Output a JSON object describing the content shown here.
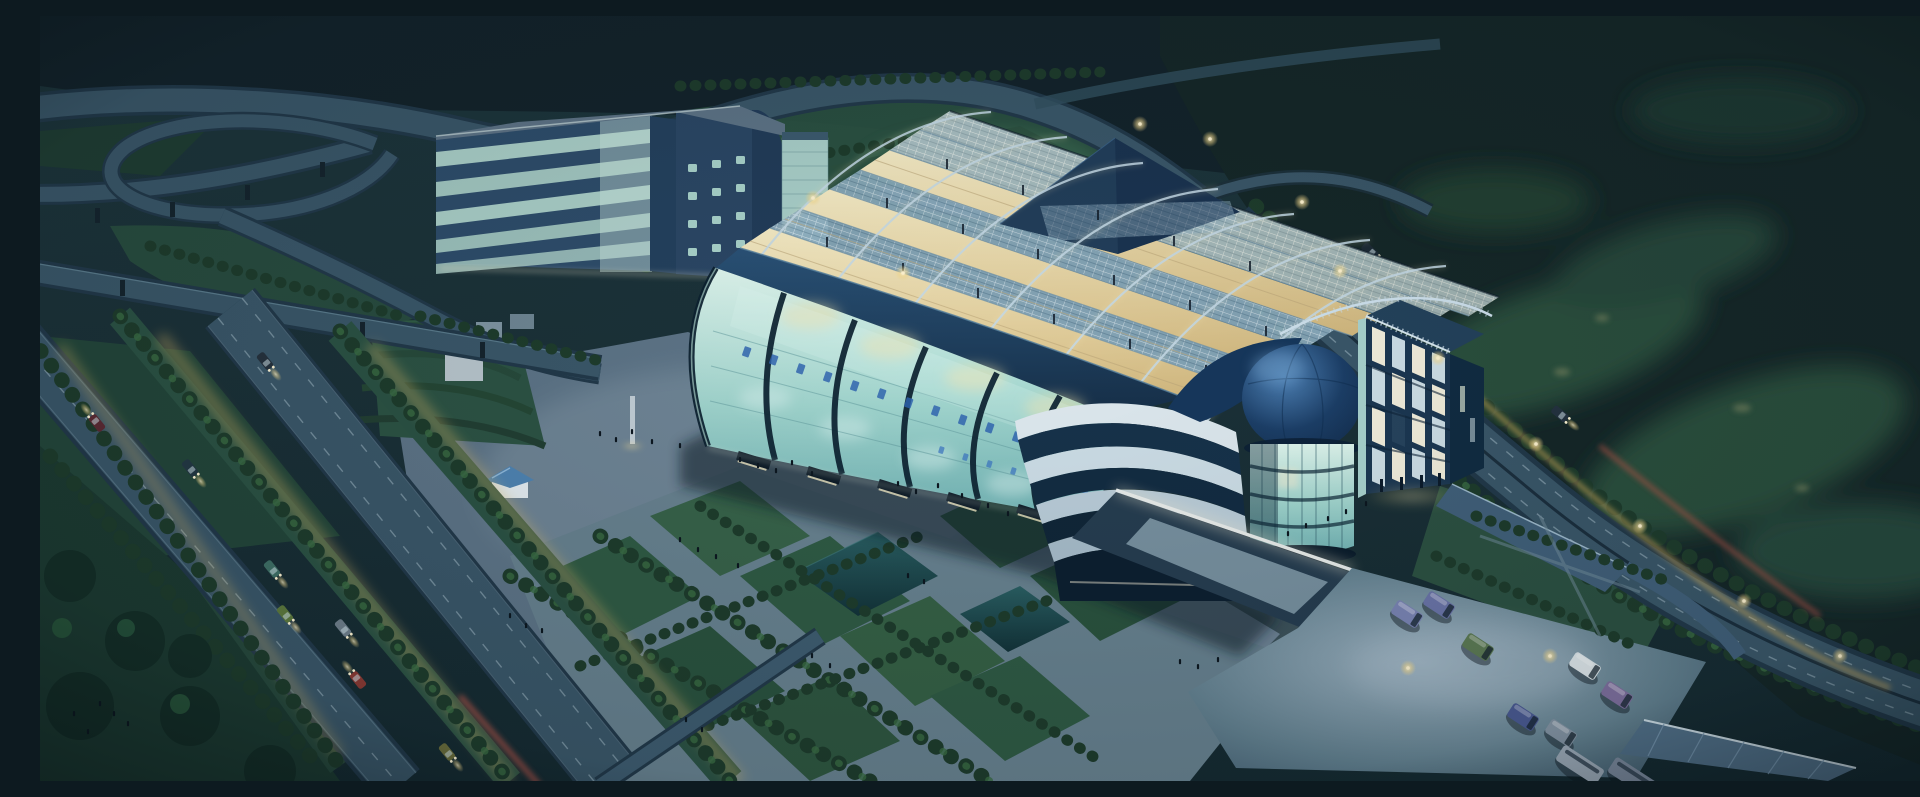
{
  "canvas": {
    "width": 1920,
    "height": 765
  },
  "scene": {
    "title": "Aerial night rendering of a glass exhibition center campus",
    "type": "architectural rendering",
    "time_of_day": "night",
    "view": "aerial oblique",
    "focal_building": "long glass exhibition hall with arched steel roof trusses lit warmly from inside",
    "secondary_buildings": [
      "striped office slab with rounded dark tower",
      "glass drum tower topped by a blue dome",
      "office block with grid of lit windows",
      "stepped curved white-banded wing"
    ],
    "landscape": [
      "dark forested hills",
      "golf-course clearings",
      "tree-lined boulevards",
      "landscaped plaza with lawns, paths and ponds"
    ],
    "infrastructure": [
      "highway interchange with loop ramp and elevated roads",
      "divided highway with vehicle light trails",
      "parking lot with vans and buses",
      "flat bus canopy",
      "sunken ramp with lit retaining wall"
    ],
    "figures": "small groups of pedestrians on the plaza and garden paths",
    "lighting": [
      "warm interior glow through roof trusses",
      "street lamps",
      "vehicle headlights",
      "yellow and red light trails"
    ],
    "signage": {
      "location": "glass facade",
      "script": "Chinese characters",
      "legible": false
    }
  },
  "vehicles": {
    "parked_vans": 7,
    "buses": 2,
    "boulevard_cars": 8,
    "highway_cars": 3,
    "van_colors": [
      "slate blue",
      "green",
      "white",
      "purple",
      "navy",
      "blue gray"
    ]
  },
  "palette": {
    "night-top": "#1d363c",
    "night-mid": "#1b3138",
    "night-low": "#152a31",
    "forest": "#152728",
    "grass-mid": "#2c5342",
    "grass-lit": "#3f7055",
    "tree-dark": "#1e3c2c",
    "tree-lit": "#3a6b44",
    "road-bed": "#22394a",
    "road-surf": "#3a5769",
    "lane": "#92aab8",
    "pave": "#5d7487",
    "glass-light": "#dff6ee",
    "glass-deep": "#6fb2b4",
    "navy": "#1d4266",
    "steel": "#a6c4d4",
    "warm": "#f2e7bd",
    "amber": "#d6bd84",
    "dome-blue": "#1c3f68",
    "dome-highlight": "#4f83b8",
    "office-band-light": "#aacfc8",
    "office-band-dark": "#2e4d6b",
    "window-warm": "#f3efdd",
    "window-cool": "#cfe0e8",
    "sign": "#2e63b0",
    "glow": "#f4d98b",
    "trail-yellow": "#d9b25e",
    "trail-red": "#c05548",
    "pond": "#265a5e",
    "van-slate": "#6a74a8",
    "van-green": "#5c7a54",
    "van-white": "#dde6ea",
    "van-purple": "#7e6f9e",
    "white-trim": "#dde8ee"
  }
}
